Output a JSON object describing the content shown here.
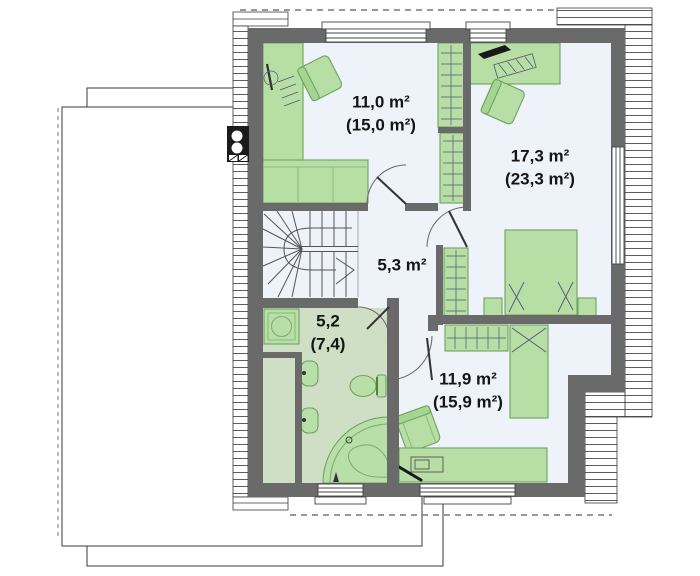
{
  "plan": {
    "type": "attic-floor-plan",
    "rooms": [
      {
        "id": "bedroom-top-left",
        "area": "11,0 m²",
        "area_gross": "(15,0 m²)"
      },
      {
        "id": "bedroom-right",
        "area": "17,3 m²",
        "area_gross": "(23,3 m²)"
      },
      {
        "id": "hall",
        "area": "5,3 m²",
        "area_gross": ""
      },
      {
        "id": "bathroom",
        "area": "5,2",
        "area_gross": "(7,4)"
      },
      {
        "id": "bedroom-bottom",
        "area": "11,9 m²",
        "area_gross": "(15,9 m²)"
      }
    ],
    "colors": {
      "wall": "#6a6a6a",
      "floor": "#eef2f9",
      "bath_floor": "#cfdfc5",
      "furniture_fill": "#b7dfa5",
      "furniture_stroke": "#6fa25e",
      "hatch_line": "#4a4a4a",
      "label_text": "#151515"
    }
  }
}
